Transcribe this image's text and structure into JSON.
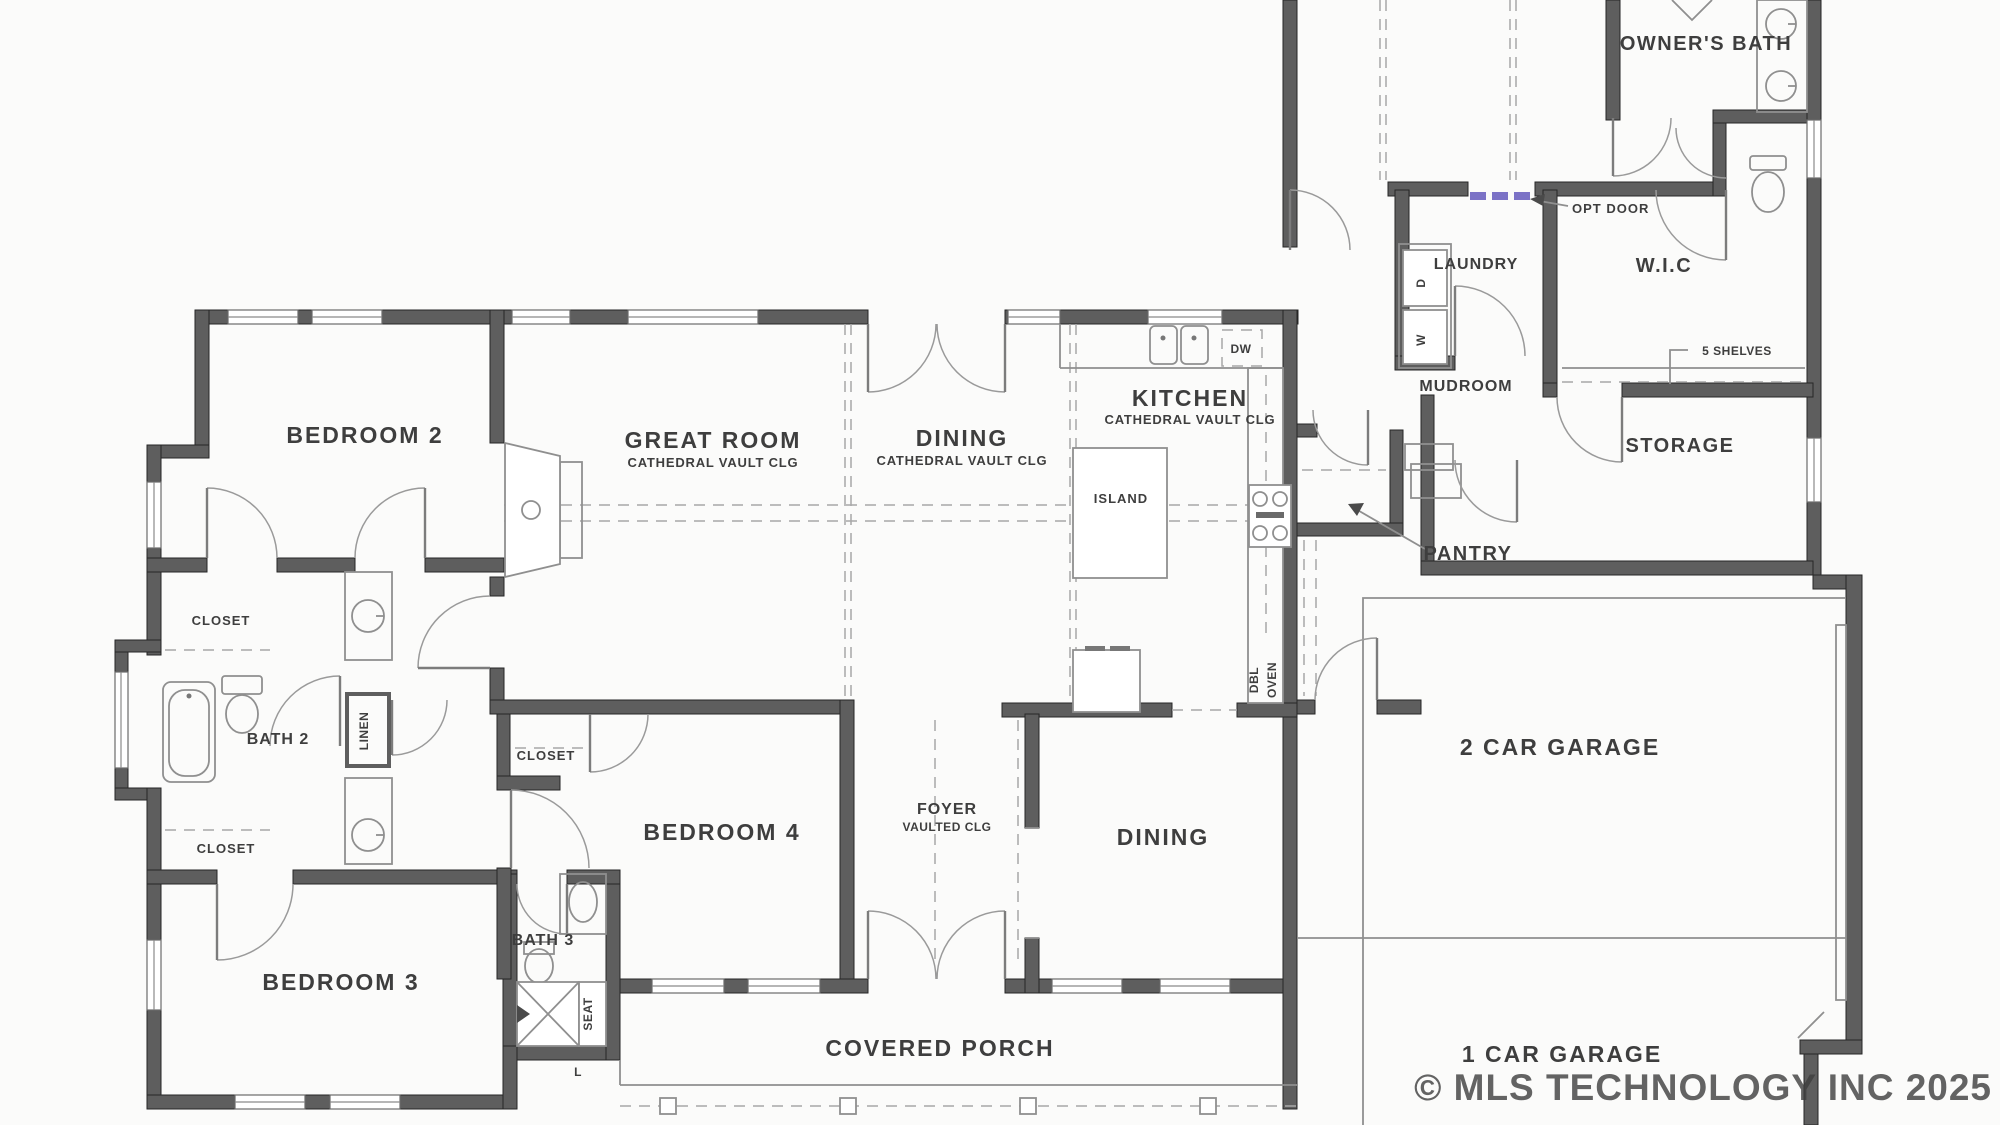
{
  "plan": {
    "labels": {
      "bedroom2": "BEDROOM 2",
      "great_room": "GREAT ROOM",
      "great_room_sub": "CATHEDRAL VAULT CLG",
      "dining_top": "DINING",
      "dining_top_sub": "CATHEDRAL VAULT CLG",
      "kitchen": "KITCHEN",
      "kitchen_sub": "CATHEDRAL VAULT CLG",
      "island": "ISLAND",
      "dw": "DW",
      "dbl": "DBL",
      "oven": "OVEN",
      "owners_bath": "OWNER'S BATH",
      "opt_door": "OPT DOOR",
      "laundry": "LAUNDRY",
      "dryer": "D",
      "washer": "W",
      "wic": "W.I.C",
      "shelves": "5 SHELVES",
      "mudroom": "MUDROOM",
      "storage": "STORAGE",
      "pantry": "PANTRY",
      "garage2": "2 CAR GARAGE",
      "garage1": "1 CAR GARAGE",
      "closet_a": "CLOSET",
      "bath2": "BATH 2",
      "linen": "LINEN",
      "closet_b": "CLOSET",
      "bedroom3": "BEDROOM 3",
      "bath3": "BATH 3",
      "seat": "SEAT",
      "l_marker": "L",
      "closet_c": "CLOSET",
      "bedroom4": "BEDROOM 4",
      "foyer": "FOYER",
      "foyer_sub": "VAULTED CLG",
      "dining_front": "DINING",
      "covered_porch": "COVERED PORCH",
      "watermark": "© MLS TECHNOLOGY INC 2025"
    },
    "colors": {
      "wall": "#5e5e5e",
      "line": "#8f8f8f",
      "text": "#3e3e3e",
      "opt_door_accent": "#7b72c6",
      "watermark": "#9f9f9f"
    }
  }
}
